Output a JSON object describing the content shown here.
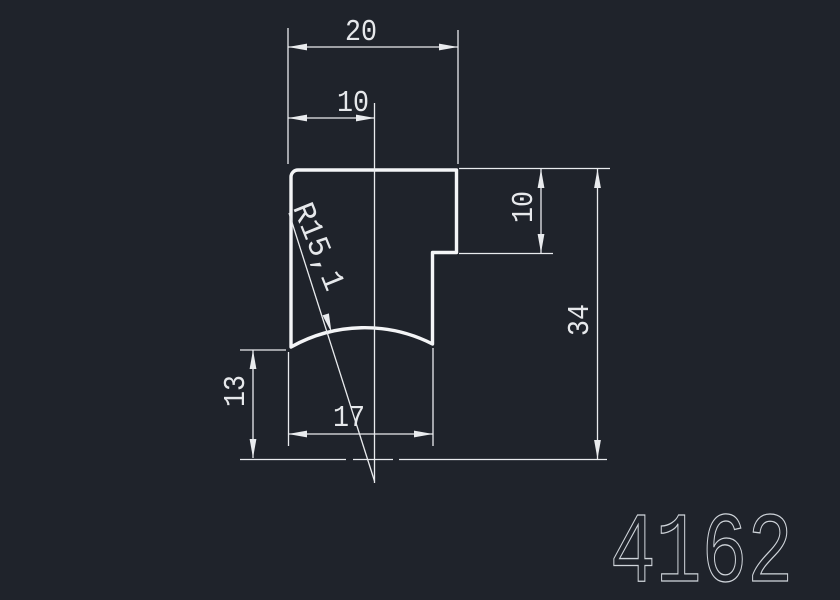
{
  "colors": {
    "background": "#1f232b",
    "line": "#e9ebee",
    "outline": "#f4f5f7",
    "dim_text": "#e6e8eb",
    "part_text": "#cfd4da"
  },
  "drawing": {
    "dimensions": {
      "width_total": "20",
      "width_left": "10",
      "step_height": "10",
      "height_total": "34",
      "height_left": "13",
      "width_bottom": "17",
      "radius_label": "R15,1"
    },
    "part_number": "4162"
  }
}
